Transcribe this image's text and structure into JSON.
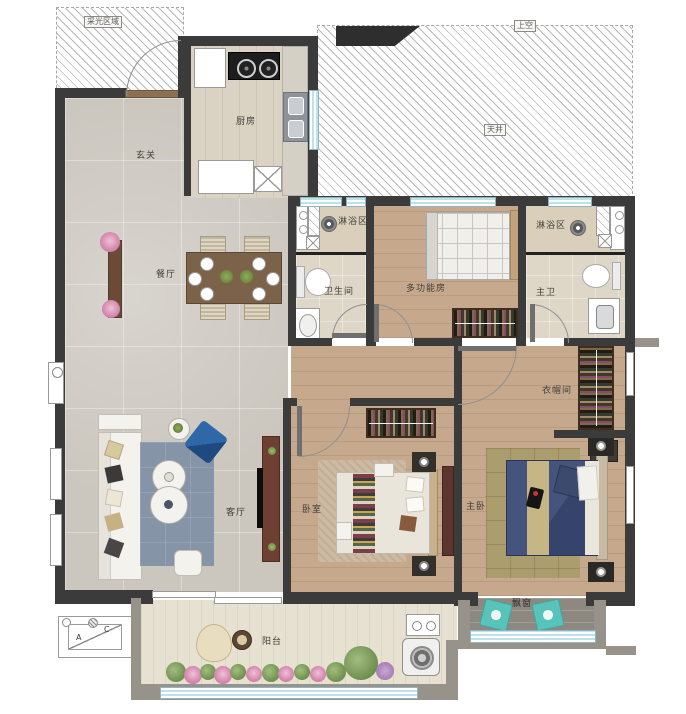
{
  "plan": {
    "areas": {
      "daylight": "采光区域",
      "open_above": "上空",
      "light_well": "天井"
    },
    "rooms": {
      "entry": "玄关",
      "kitchen": "厨房",
      "dining": "餐厅",
      "shower_1": "淋浴区",
      "bathroom": "卫生间",
      "multi_room": "多功能房",
      "shower_2": "淋浴区",
      "master_bath": "主卫",
      "closet": "衣帽间",
      "living": "客厅",
      "bedroom": "卧室",
      "master_bedroom": "主卧",
      "balcony": "阳台",
      "bay_window": "飘窗"
    },
    "marks": {
      "a": "A",
      "c": "C"
    },
    "colors": {
      "wall": "#3b3b3b",
      "secondary_wall": "#97928a",
      "marble_floor": "#cbc6be",
      "wood_floor": "#c6a98d",
      "window_glass": "#bfe2ea",
      "living_rug": "#8594a6",
      "master_bed": "#3e4c70",
      "accent_teal": "#58c3ba",
      "accent_blue": "#2f68a8"
    }
  }
}
